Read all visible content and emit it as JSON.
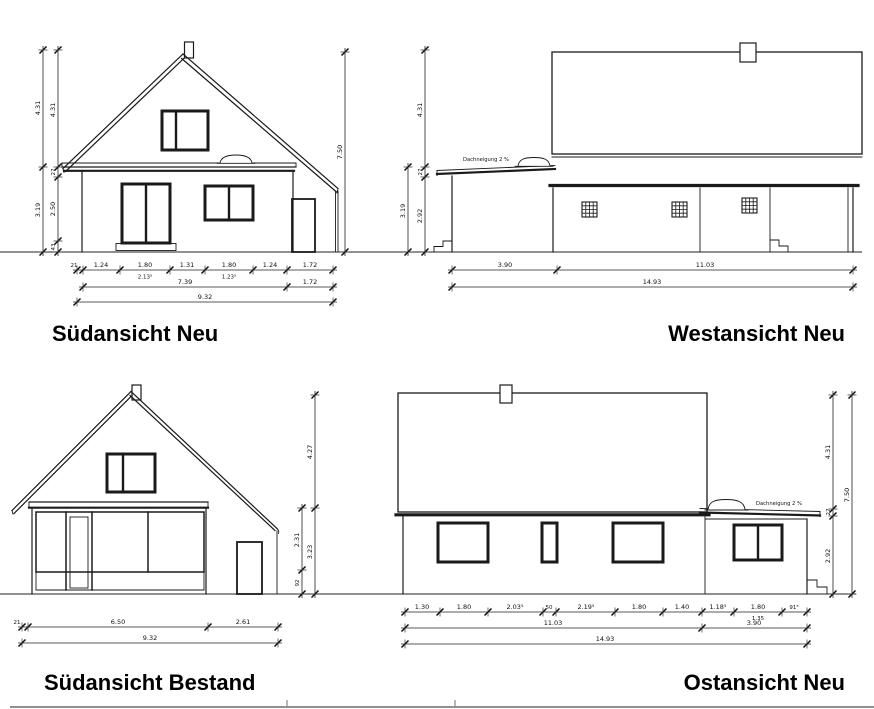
{
  "views": {
    "sued_neu": {
      "title": "Südansicht Neu",
      "dims": {
        "left_outer": [
          "4.31",
          "3.19"
        ],
        "left_inner": [
          "4.31",
          "27",
          "2.50",
          "43"
        ],
        "right_total": "7.50",
        "row1": [
          "21",
          "1.24",
          "1.80",
          "1.31",
          "1.80",
          "1.24",
          "1.72"
        ],
        "row1_sub": [
          "2.13⁵",
          "1.23⁵"
        ],
        "row2": [
          "7.39",
          "1.72"
        ],
        "row3": "9.32"
      }
    },
    "west_neu": {
      "title": "Westansicht Neu",
      "roof_note": "Dachneigung 2 %",
      "dims": {
        "left_outer": "3.19",
        "left_inner": [
          "4.31",
          "27",
          "2.92"
        ],
        "row1": [
          "3.90",
          "11.03"
        ],
        "row2": "14.93"
      }
    },
    "sued_bestand": {
      "title": "Südansicht Bestand",
      "dims": {
        "right_inner": [
          "2.31",
          "92"
        ],
        "right_outer": [
          "4.27",
          "3.23"
        ],
        "row1": [
          "21",
          "6.50",
          "2.61"
        ],
        "row2": "9.32"
      }
    },
    "ost_neu": {
      "title": "Ostansicht Neu",
      "roof_note": "Dachneigung 2 %",
      "dims": {
        "right_inner": [
          "4.31",
          "27",
          "2.92"
        ],
        "right_total": "7.50",
        "row1": [
          "1.30",
          "1.80",
          "2.03⁵",
          "50",
          "2.19⁵",
          "1.80",
          "1.40",
          "1.18⁵",
          "1.80",
          "91⁵"
        ],
        "row1_sub": "1.35",
        "row2": [
          "11.03",
          "3.90"
        ],
        "row3": "14.93"
      }
    }
  }
}
